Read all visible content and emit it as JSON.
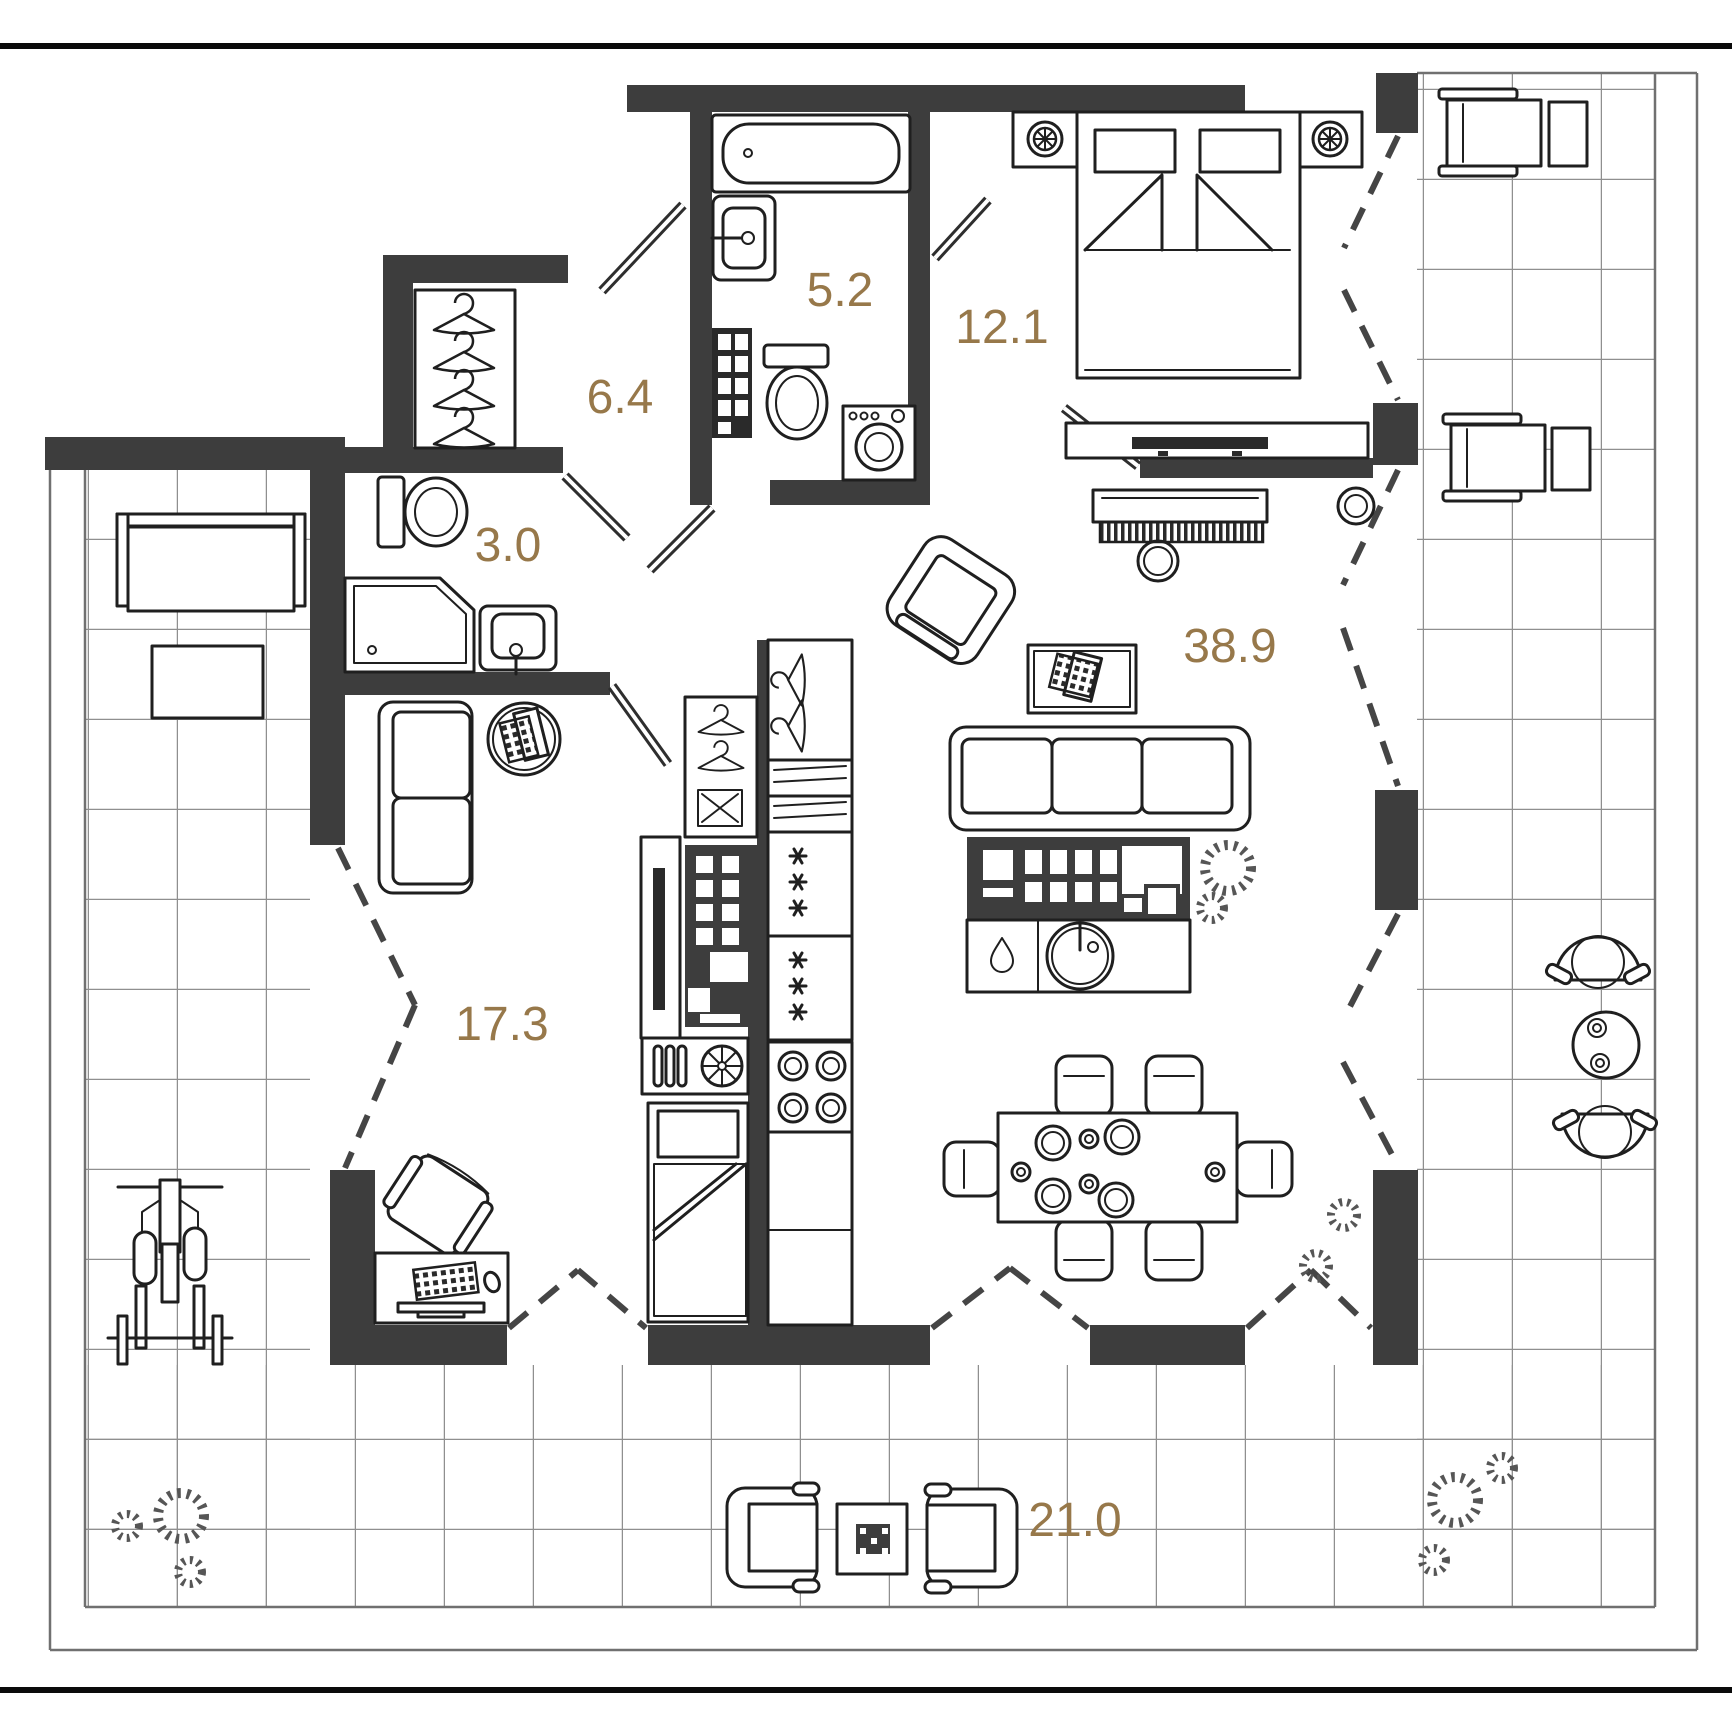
{
  "floor_plan": {
    "accent_color": "#97784a",
    "wall_color": "#3d3d3d",
    "rooms": [
      {
        "id": "bathroom",
        "area_label": "5.2"
      },
      {
        "id": "bedroom",
        "area_label": "12.1"
      },
      {
        "id": "entry-hall",
        "area_label": "6.4"
      },
      {
        "id": "shower-wc",
        "area_label": "3.0"
      },
      {
        "id": "living-kitchen",
        "area_label": "38.9"
      },
      {
        "id": "second-room",
        "area_label": "17.3"
      },
      {
        "id": "terrace",
        "area_label": "21.0"
      }
    ]
  }
}
